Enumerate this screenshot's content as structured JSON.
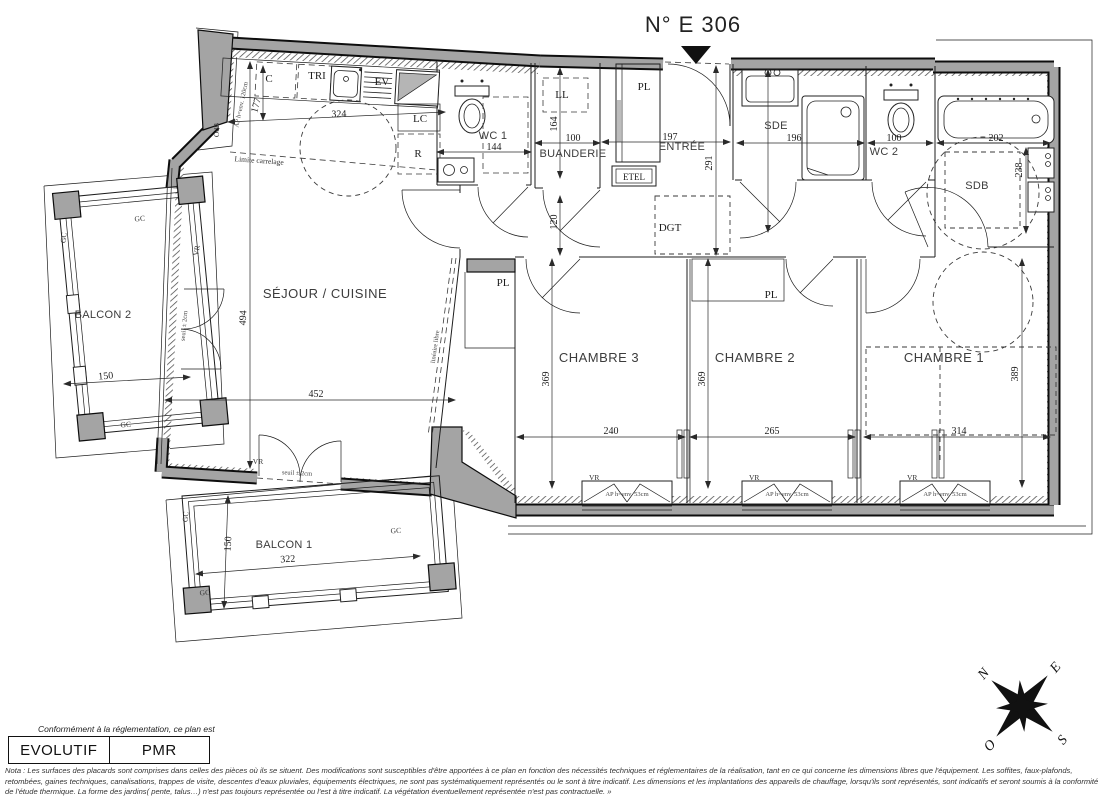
{
  "title": "N° E 306",
  "rooms": {
    "sejour": {
      "label": "SÉJOUR / CUISINE",
      "width": "452",
      "height": "494"
    },
    "chambre1": {
      "label": "CHAMBRE 1",
      "width": "314",
      "height": "389"
    },
    "chambre2": {
      "label": "CHAMBRE 2",
      "width": "265",
      "height": "369"
    },
    "chambre3": {
      "label": "CHAMBRE 3",
      "width": "240",
      "height": "369"
    },
    "wc1": {
      "label": "WC 1",
      "width": "144"
    },
    "buanderie": {
      "label": "BUANDERIE",
      "width": "100",
      "height": "164"
    },
    "entree": {
      "label": "ENTRÉE",
      "width": "197",
      "height": "291"
    },
    "dgt": {
      "label": "DGT",
      "width": "120"
    },
    "sde": {
      "label": "SDE",
      "width": "196"
    },
    "wc2": {
      "label": "WC 2",
      "width": "100"
    },
    "sdb": {
      "label": "SDB",
      "width": "202",
      "height": "238"
    },
    "balcon1": {
      "label": "BALCON 1",
      "width": "322",
      "height": "150"
    },
    "balcon2": {
      "label": "BALCON 2",
      "width": "150"
    }
  },
  "kitchen": {
    "c": "C",
    "tri": "TRI",
    "ev": "EV",
    "lc": "LC",
    "r": "R",
    "depth": "177",
    "width": "324"
  },
  "laundry": {
    "ll": "LL",
    "etel": "ETEL"
  },
  "annotations": {
    "pl": "PL",
    "vr": "VR",
    "gc": "GC",
    "odb": "OdB",
    "ap_kitchen": "AP h=env. 120cm",
    "ap_window": "AP h=env. 53cm",
    "limite_carrelage": "Limite carrelage",
    "seuil": "seuil ± 2cm",
    "libre": "linéaire libre"
  },
  "compass": {
    "n": "N",
    "e": "E",
    "s": "S",
    "o": "O"
  },
  "legend": {
    "intro": "Conformément à la réglementation, ce plan est",
    "evolutif": "EVOLUTIF",
    "pmr": "PMR"
  },
  "nota": {
    "line1": "Nota : Les surfaces des placards sont comprises dans celles des pièces où ils se situent. Des modifications sont susceptibles d'être apportées à ce plan en fonction des nécessités techniques et réglementaires de la réalisation, tant en ce qui concerne les dimensions libres que l'équipement.  Les soffites, faux-plafonds,",
    "line2": "retombées, gaines techniques, canalisations, trappes de visite, descentes d'eaux pluviales, équipements électriques, ne sont pas systématiquement représentés ou le sont à titre indicatif. Les dimensions et les implantations des appareils de chauffage, lorsqu'ils sont représentés, sont indicatifs et seront soumis à la conformité",
    "line3": "de l'étude thermique. La forme des jardins( pente, talus…) n'est pas toujours représentée ou l'est à titre indicatif. La végétation éventuellement représentée n'est pas contractuelle. »"
  }
}
